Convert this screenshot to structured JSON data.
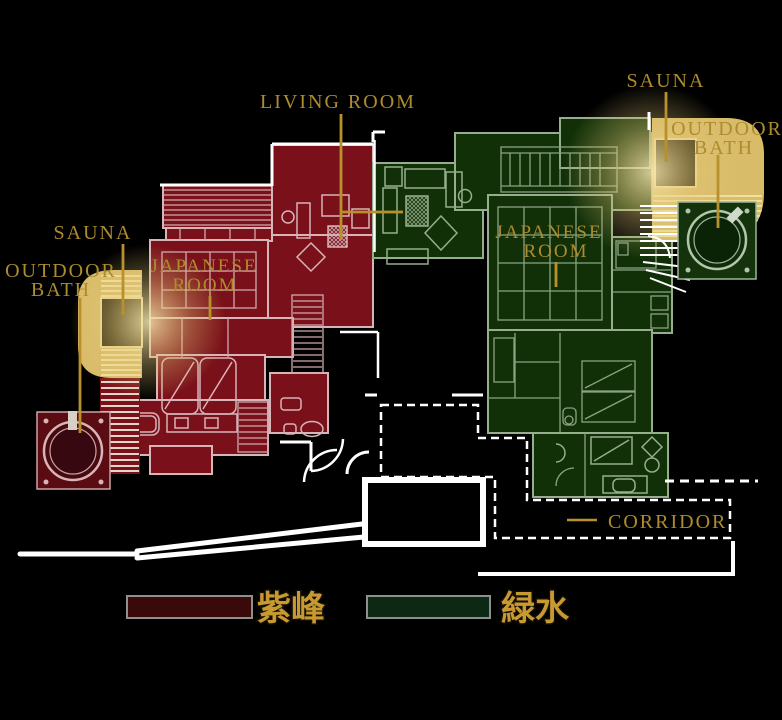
{
  "title": "Ryokan villa floor plan",
  "labels": {
    "living_room": "LIVING ROOM",
    "sauna_right": "SAUNA",
    "sauna_left": "SAUNA",
    "outdoor_bath_right": {
      "line1": "OUTDOOR",
      "line2": "BATH"
    },
    "outdoor_bath_left": {
      "line1": "OUTDOOR",
      "line2": "BATH"
    },
    "japanese_room_left": {
      "line1": "JAPANESE",
      "line2": "ROOM"
    },
    "japanese_room_right": {
      "line1": "JAPANESE",
      "line2": "ROOM"
    },
    "corridor": "CORRIDOR"
  },
  "legend": {
    "items": [
      {
        "name": "shihou",
        "label": "紫峰",
        "color": "#3a0a0b"
      },
      {
        "name": "ryokusui",
        "label": "緑水",
        "color": "#0d2913"
      }
    ]
  },
  "colors": {
    "background": "#000000",
    "red_villa": "#7a1019",
    "green_villa": "#123008",
    "bath_deck_tan": "#d9bc6a",
    "sauna_dark": "#32290f",
    "label_gold": "#ad8c2e",
    "corridor_line": "#ffffff"
  }
}
